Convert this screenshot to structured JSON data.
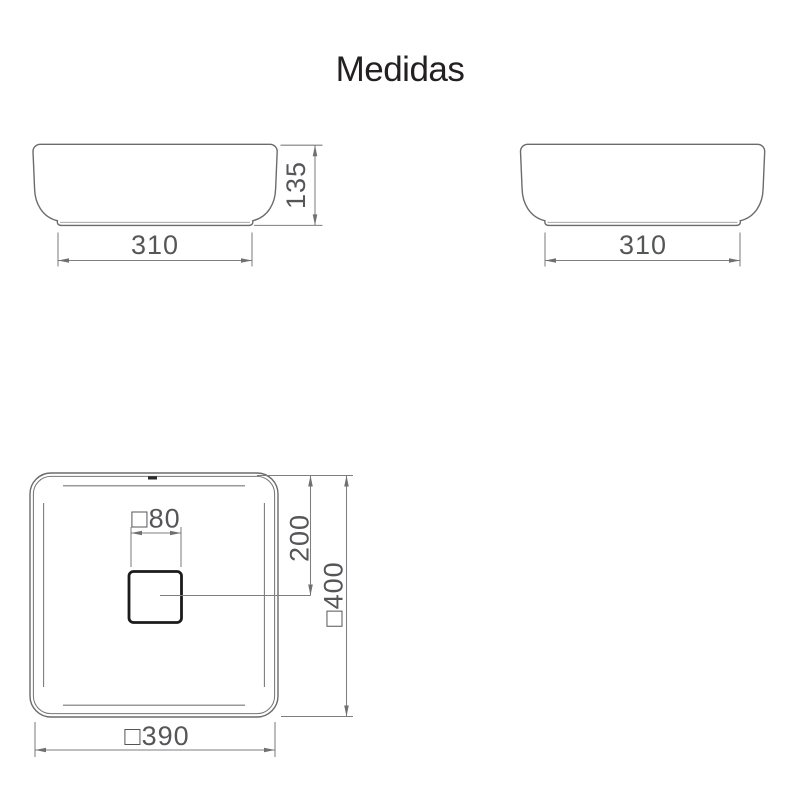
{
  "title": "Medidas",
  "colors": {
    "background": "#ffffff",
    "object_line": "#6a6b6d",
    "dimension_line": "#7d7e80",
    "dimension_text": "#555658",
    "drain_outline": "#1a1b1d",
    "title_text": "#232021"
  },
  "front_view": {
    "width_dim": "310",
    "height_dim": "135"
  },
  "side_view": {
    "width_dim": "310"
  },
  "top_view": {
    "drain_size_dim": "□80",
    "drain_offset_dim": "200",
    "overall_depth_dim": "□400",
    "overall_width_dim": "□390"
  }
}
